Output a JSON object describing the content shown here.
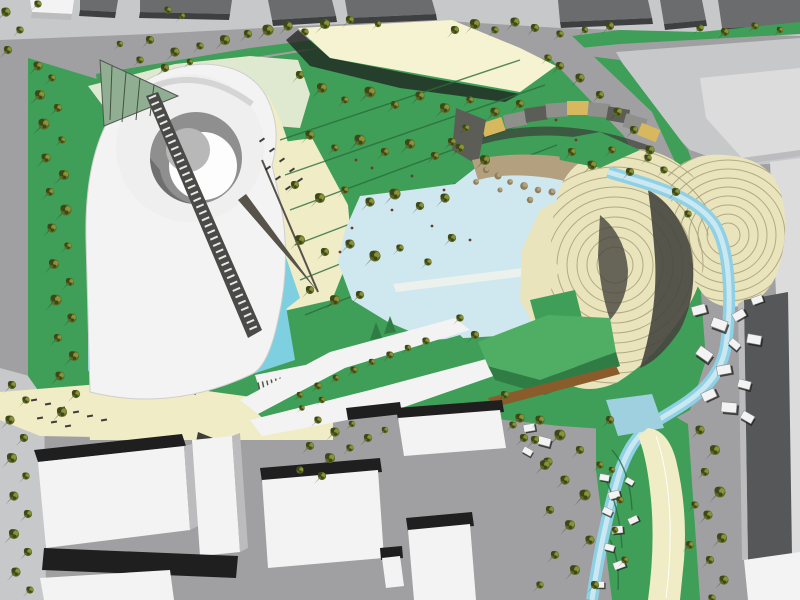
{
  "scene": {
    "description": "Aerial 3D rendering of a park masterplan: white spiral pavilion, lakes, tree groves, terraced earthwork hills, surrounding streets and city blocks",
    "colors": {
      "street": "#a0a0a2",
      "sidewalk": "#c7c8ca",
      "roof_dark": "#6b6c6e",
      "roof_side": "#3e3f41",
      "shadow": "#1f1f1f",
      "grass": "#3f9e57",
      "grass_bright": "#4fae63",
      "grass_dark": "#2f7d45",
      "lawn_pale": "#dfe9d0",
      "cream": "#efecc6",
      "canopy": "#f6f3d2",
      "water": "#9fd0e0",
      "water_pale": "#cfe7ee",
      "water_bright": "#7ecfe0",
      "stream": "#8fd0e4",
      "stream_core": "#c9e8f2",
      "white_bldg": "#f3f3f3",
      "bldg_face": "#bcbcbe",
      "terrace": "#e9e4bc",
      "terrace_line": "#a89f79",
      "terrace_shadow": "#46453f",
      "dark_bldg": "#565759",
      "light_bldg": "#dcdcdd",
      "rock": "#b3a07e",
      "rock_dark": "#8f7f5f",
      "gold": "#d7b85e",
      "stripe_gray": "#8f8f8c",
      "stripe_dark": "#5d5d58",
      "bronze": "#8a5c2c",
      "glass_green": "#8fae92",
      "path_line": "#2a6b3c",
      "tree_mid": "#5d6a24",
      "tree_dark": "#3c471a",
      "tree_light": "#8a9136",
      "tree_shadow": "#24331c",
      "figure": "#6b3a33"
    },
    "trees": {
      "left_strip": [
        [
          38,
          66,
          1
        ],
        [
          52,
          78,
          0.8
        ],
        [
          40,
          95,
          1.1
        ],
        [
          58,
          108,
          0.9
        ],
        [
          44,
          124,
          1.2
        ],
        [
          62,
          140,
          0.8
        ],
        [
          46,
          158,
          1
        ],
        [
          64,
          175,
          1.1
        ],
        [
          50,
          192,
          0.9
        ],
        [
          66,
          210,
          1.2
        ],
        [
          52,
          228,
          1
        ],
        [
          68,
          246,
          0.8
        ],
        [
          54,
          264,
          1.1
        ],
        [
          70,
          282,
          0.9
        ],
        [
          56,
          300,
          1.2
        ],
        [
          72,
          318,
          1
        ],
        [
          58,
          338,
          0.9
        ],
        [
          74,
          356,
          1.1
        ],
        [
          60,
          376,
          1
        ],
        [
          76,
          394,
          0.9
        ],
        [
          62,
          412,
          1.1
        ],
        [
          8,
          50,
          0.9
        ],
        [
          20,
          30,
          0.8
        ],
        [
          6,
          12,
          1
        ]
      ],
      "top_verge": [
        [
          120,
          44,
          0.7
        ],
        [
          150,
          40,
          0.9
        ],
        [
          175,
          52,
          1
        ],
        [
          200,
          46,
          0.8
        ],
        [
          225,
          40,
          1.1
        ],
        [
          248,
          34,
          0.9
        ],
        [
          268,
          30,
          1.2
        ],
        [
          288,
          26,
          1
        ],
        [
          305,
          32,
          0.8
        ],
        [
          325,
          24,
          1.1
        ],
        [
          350,
          20,
          0.9
        ],
        [
          378,
          24,
          0.7
        ],
        [
          455,
          30,
          0.9
        ],
        [
          475,
          24,
          1.1
        ],
        [
          495,
          30,
          0.8
        ],
        [
          515,
          22,
          1
        ],
        [
          535,
          28,
          0.9
        ],
        [
          560,
          34,
          0.8
        ],
        [
          585,
          30,
          0.7
        ],
        [
          610,
          26,
          0.9
        ],
        [
          700,
          28,
          0.8
        ],
        [
          725,
          32,
          0.9
        ],
        [
          755,
          26,
          0.8
        ],
        [
          780,
          30,
          0.7
        ],
        [
          140,
          60,
          0.8
        ],
        [
          165,
          68,
          0.9
        ],
        [
          190,
          62,
          0.7
        ],
        [
          168,
          10,
          0.8
        ],
        [
          182,
          16,
          0.7
        ],
        [
          38,
          4,
          0.8
        ]
      ],
      "central_grove": [
        [
          300,
          75,
          0.9
        ],
        [
          322,
          88,
          1.1
        ],
        [
          345,
          100,
          0.8
        ],
        [
          370,
          92,
          1.2
        ],
        [
          395,
          105,
          0.9
        ],
        [
          420,
          96,
          1
        ],
        [
          445,
          108,
          1.1
        ],
        [
          470,
          100,
          0.8
        ],
        [
          495,
          112,
          1
        ],
        [
          520,
          104,
          0.9
        ],
        [
          310,
          135,
          1
        ],
        [
          335,
          148,
          0.8
        ],
        [
          360,
          140,
          1.2
        ],
        [
          385,
          152,
          0.9
        ],
        [
          410,
          144,
          1.1
        ],
        [
          435,
          156,
          0.9
        ],
        [
          460,
          148,
          1
        ],
        [
          485,
          160,
          1.1
        ],
        [
          295,
          185,
          0.9
        ],
        [
          320,
          198,
          1.1
        ],
        [
          345,
          190,
          0.8
        ],
        [
          370,
          202,
          1
        ],
        [
          395,
          194,
          1.2
        ],
        [
          420,
          206,
          0.9
        ],
        [
          445,
          198,
          1
        ],
        [
          300,
          240,
          1.1
        ],
        [
          325,
          252,
          0.9
        ],
        [
          350,
          244,
          1
        ],
        [
          375,
          256,
          1.2
        ],
        [
          400,
          248,
          0.8
        ],
        [
          310,
          290,
          0.9
        ],
        [
          335,
          300,
          1.1
        ],
        [
          360,
          295,
          0.9
        ],
        [
          428,
          262,
          0.8
        ],
        [
          452,
          238,
          0.9
        ],
        [
          466,
          128,
          0.8
        ],
        [
          452,
          142,
          0.9
        ]
      ],
      "ridge_band": [
        [
          548,
          58,
          0.8
        ],
        [
          560,
          66,
          0.9
        ],
        [
          580,
          78,
          1
        ],
        [
          600,
          95,
          0.9
        ],
        [
          618,
          112,
          1
        ],
        [
          634,
          130,
          0.9
        ],
        [
          650,
          150,
          1
        ],
        [
          664,
          170,
          0.8
        ],
        [
          676,
          192,
          0.9
        ],
        [
          688,
          214,
          0.8
        ]
      ],
      "terrace_top": [
        [
          572,
          152,
          0.9
        ],
        [
          592,
          165,
          1
        ],
        [
          612,
          150,
          0.8
        ],
        [
          630,
          172,
          0.9
        ],
        [
          648,
          158,
          0.8
        ]
      ],
      "pond_edge": [
        [
          460,
          318,
          0.8
        ],
        [
          475,
          335,
          0.9
        ],
        [
          505,
          395,
          0.9
        ],
        [
          520,
          418,
          1
        ],
        [
          535,
          440,
          0.9
        ],
        [
          548,
          462,
          1
        ]
      ],
      "roof_strip": [
        [
          300,
          395,
          0.7
        ],
        [
          318,
          386,
          0.8
        ],
        [
          336,
          378,
          0.7
        ],
        [
          354,
          370,
          0.8
        ],
        [
          372,
          362,
          0.7
        ],
        [
          390,
          355,
          0.8
        ],
        [
          408,
          348,
          0.7
        ],
        [
          426,
          341,
          0.8
        ],
        [
          302,
          408,
          0.6
        ],
        [
          322,
          400,
          0.7
        ]
      ],
      "plaza_center": [
        [
          318,
          420,
          0.8
        ],
        [
          335,
          432,
          1
        ],
        [
          352,
          424,
          0.7
        ],
        [
          310,
          446,
          0.9
        ],
        [
          330,
          458,
          1.1
        ],
        [
          350,
          448,
          0.8
        ],
        [
          368,
          438,
          0.9
        ],
        [
          385,
          430,
          0.7
        ],
        [
          300,
          470,
          0.8
        ],
        [
          322,
          476,
          0.9
        ],
        [
          513,
          425,
          0.8
        ],
        [
          524,
          438,
          0.9
        ]
      ],
      "plaza_right": [
        [
          540,
          420,
          1
        ],
        [
          560,
          435,
          1.2
        ],
        [
          580,
          450,
          0.9
        ],
        [
          545,
          465,
          1.1
        ],
        [
          565,
          480,
          1
        ],
        [
          585,
          495,
          1.2
        ],
        [
          550,
          510,
          0.9
        ],
        [
          570,
          525,
          1.1
        ],
        [
          590,
          540,
          1
        ],
        [
          555,
          555,
          0.9
        ],
        [
          575,
          570,
          1.1
        ],
        [
          595,
          585,
          0.9
        ],
        [
          540,
          585,
          0.8
        ],
        [
          610,
          420,
          0.9
        ],
        [
          600,
          465,
          0.8
        ]
      ],
      "east_strip": [
        [
          700,
          430,
          1
        ],
        [
          715,
          450,
          1.1
        ],
        [
          705,
          472,
          0.9
        ],
        [
          720,
          492,
          1.2
        ],
        [
          708,
          515,
          1
        ],
        [
          722,
          538,
          1.1
        ],
        [
          710,
          560,
          0.9
        ],
        [
          724,
          580,
          1
        ],
        [
          712,
          598,
          0.8
        ],
        [
          695,
          505,
          0.8
        ],
        [
          690,
          545,
          0.9
        ],
        [
          612,
          470,
          0.7
        ],
        [
          620,
          500,
          0.8
        ],
        [
          615,
          530,
          0.7
        ],
        [
          625,
          560,
          0.8
        ]
      ],
      "sidewalk_sw": [
        [
          12,
          385,
          0.9
        ],
        [
          26,
          400,
          0.8
        ],
        [
          10,
          420,
          1
        ],
        [
          24,
          438,
          0.9
        ],
        [
          12,
          458,
          1.1
        ],
        [
          26,
          476,
          0.8
        ],
        [
          14,
          496,
          1
        ],
        [
          28,
          514,
          0.9
        ],
        [
          14,
          534,
          1.1
        ],
        [
          28,
          552,
          0.9
        ],
        [
          16,
          572,
          1
        ],
        [
          30,
          590,
          0.8
        ]
      ]
    },
    "rocks": [
      [
        486,
        170,
        1
      ],
      [
        498,
        176,
        1.1
      ],
      [
        510,
        182,
        0.9
      ],
      [
        524,
        186,
        1.2
      ],
      [
        538,
        190,
        1
      ],
      [
        552,
        192,
        1.1
      ],
      [
        566,
        192,
        0.9
      ],
      [
        580,
        190,
        1
      ],
      [
        594,
        186,
        1.1
      ],
      [
        606,
        180,
        0.9
      ],
      [
        616,
        172,
        1
      ],
      [
        500,
        190,
        0.8
      ],
      [
        530,
        200,
        1
      ],
      [
        560,
        202,
        0.9
      ],
      [
        590,
        198,
        0.8
      ],
      [
        476,
        182,
        0.9
      ]
    ],
    "pavilions": {
      "hillside": [
        [
          700,
          310,
          1,
          -15
        ],
        [
          720,
          325,
          1.1,
          20
        ],
        [
          740,
          315,
          0.9,
          -30
        ],
        [
          755,
          340,
          1,
          10
        ],
        [
          705,
          355,
          1.1,
          35
        ],
        [
          725,
          370,
          1,
          -10
        ],
        [
          745,
          385,
          0.9,
          15
        ],
        [
          710,
          395,
          1,
          -25
        ],
        [
          730,
          408,
          1.1,
          5
        ],
        [
          748,
          418,
          0.9,
          30
        ],
        [
          758,
          300,
          0.8,
          -20
        ],
        [
          735,
          345,
          0.8,
          40
        ]
      ],
      "strip": [
        [
          605,
          478,
          0.7,
          10
        ],
        [
          615,
          495,
          0.8,
          -15
        ],
        [
          608,
          512,
          0.7,
          25
        ],
        [
          618,
          530,
          0.8,
          -5
        ],
        [
          610,
          548,
          0.7,
          15
        ],
        [
          620,
          565,
          0.8,
          -20
        ],
        [
          630,
          482,
          0.6,
          30
        ],
        [
          634,
          520,
          0.7,
          -25
        ],
        [
          600,
          585,
          0.7,
          0
        ]
      ],
      "plaza_edge": [
        [
          530,
          428,
          0.8,
          -10
        ],
        [
          545,
          442,
          0.9,
          15
        ],
        [
          528,
          452,
          0.7,
          30
        ]
      ]
    },
    "dashes": {
      "spiral_plaza": [
        [
          262,
          140,
          1,
          -35
        ],
        [
          272,
          150,
          1,
          -35
        ],
        [
          282,
          160,
          1,
          -35
        ],
        [
          292,
          170,
          1,
          -35
        ],
        [
          300,
          180,
          1,
          -35
        ],
        [
          268,
          168,
          1,
          -35
        ],
        [
          278,
          178,
          1,
          -35
        ],
        [
          288,
          188,
          1,
          -35
        ]
      ],
      "southwest_plaza": [
        [
          34,
          400,
          1,
          -10
        ],
        [
          48,
          404,
          1,
          -10
        ],
        [
          62,
          408,
          1,
          -10
        ],
        [
          76,
          412,
          1,
          -10
        ],
        [
          90,
          416,
          1,
          -10
        ],
        [
          104,
          420,
          1,
          -10
        ],
        [
          40,
          418,
          1,
          -10
        ],
        [
          54,
          422,
          1,
          -10
        ],
        [
          68,
          426,
          1,
          -10
        ]
      ]
    },
    "figures": [
      [
        356,
        160,
        1,
        0
      ],
      [
        372,
        168,
        1,
        0
      ],
      [
        412,
        176,
        1,
        0
      ],
      [
        444,
        190,
        1,
        0
      ],
      [
        392,
        210,
        1,
        0
      ],
      [
        352,
        228,
        1,
        0
      ],
      [
        432,
        226,
        1,
        0
      ],
      [
        470,
        240,
        1,
        0
      ],
      [
        340,
        252,
        1,
        0
      ],
      [
        556,
        120,
        1,
        0
      ],
      [
        576,
        140,
        1,
        0
      ]
    ]
  }
}
